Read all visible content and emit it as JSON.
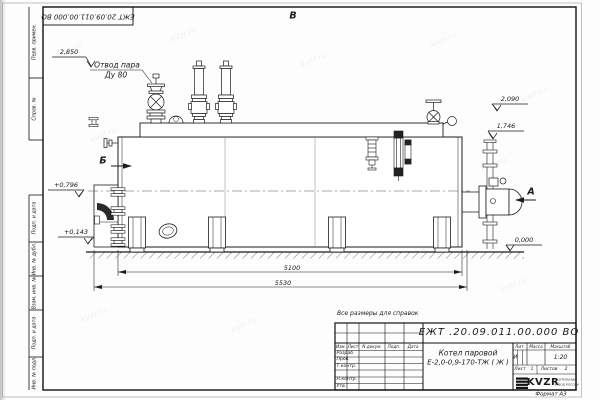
{
  "watermark": "kvzr.ru",
  "stamp_top": "ЕЖТ 20.09.011.00.000  ВО",
  "views": {
    "top": "В",
    "left": "Б",
    "right": "А"
  },
  "callout": {
    "line1": "Отвод пара",
    "line2": "Ду 80"
  },
  "elevations": {
    "e2850": "2,850",
    "e2090": "2,090",
    "e1746": "1,746",
    "e0796": "+0,796",
    "e0143": "+0,143",
    "e0000": "0,000"
  },
  "dimensions": {
    "d5100": "5100",
    "d5530": "5530"
  },
  "margin_columns": {
    "perv": "Перв. примен.",
    "sprav": "Справ. №",
    "podp1": "Подп. и дата",
    "inv_dubl": "Инв. № дубл.",
    "vzam": "Взам. инв. №",
    "podp2": "Подп. и дата",
    "inv_podl": "Инв. № подл."
  },
  "note": "Все размеры для справок",
  "title_block": {
    "doc_number": "ЕЖТ .20.09.011.00.000  ВО",
    "name_line1": "Котел паровой",
    "name_line2": "Е-2,0-0,9-170-ТЖ ( Ж )",
    "header": {
      "izm": "Изм.",
      "list": "Лист",
      "ndokum": "N докум.",
      "podp": "Подп.",
      "data": "Дата"
    },
    "rows": {
      "razrab": "Разраб.",
      "prov": "Пров.",
      "tkontr": "Т.контр.",
      "nkontr": "Н.контр.",
      "utv": "Утв."
    },
    "lit_header": "Лит.",
    "mass_header": "Масса",
    "scale_header": "Масштаб",
    "lit_value": "И",
    "scale_value": "1:20",
    "sheet_label": "Лист",
    "sheet_value": "1",
    "sheets_label": "Листов",
    "sheets_value": "2",
    "logo_text": "KVZR",
    "logo_sub1": "КОТЕЛЬНЫЙ",
    "logo_sub2": "ЗАВОД РОССИИ",
    "format_label": "Формат А3"
  }
}
